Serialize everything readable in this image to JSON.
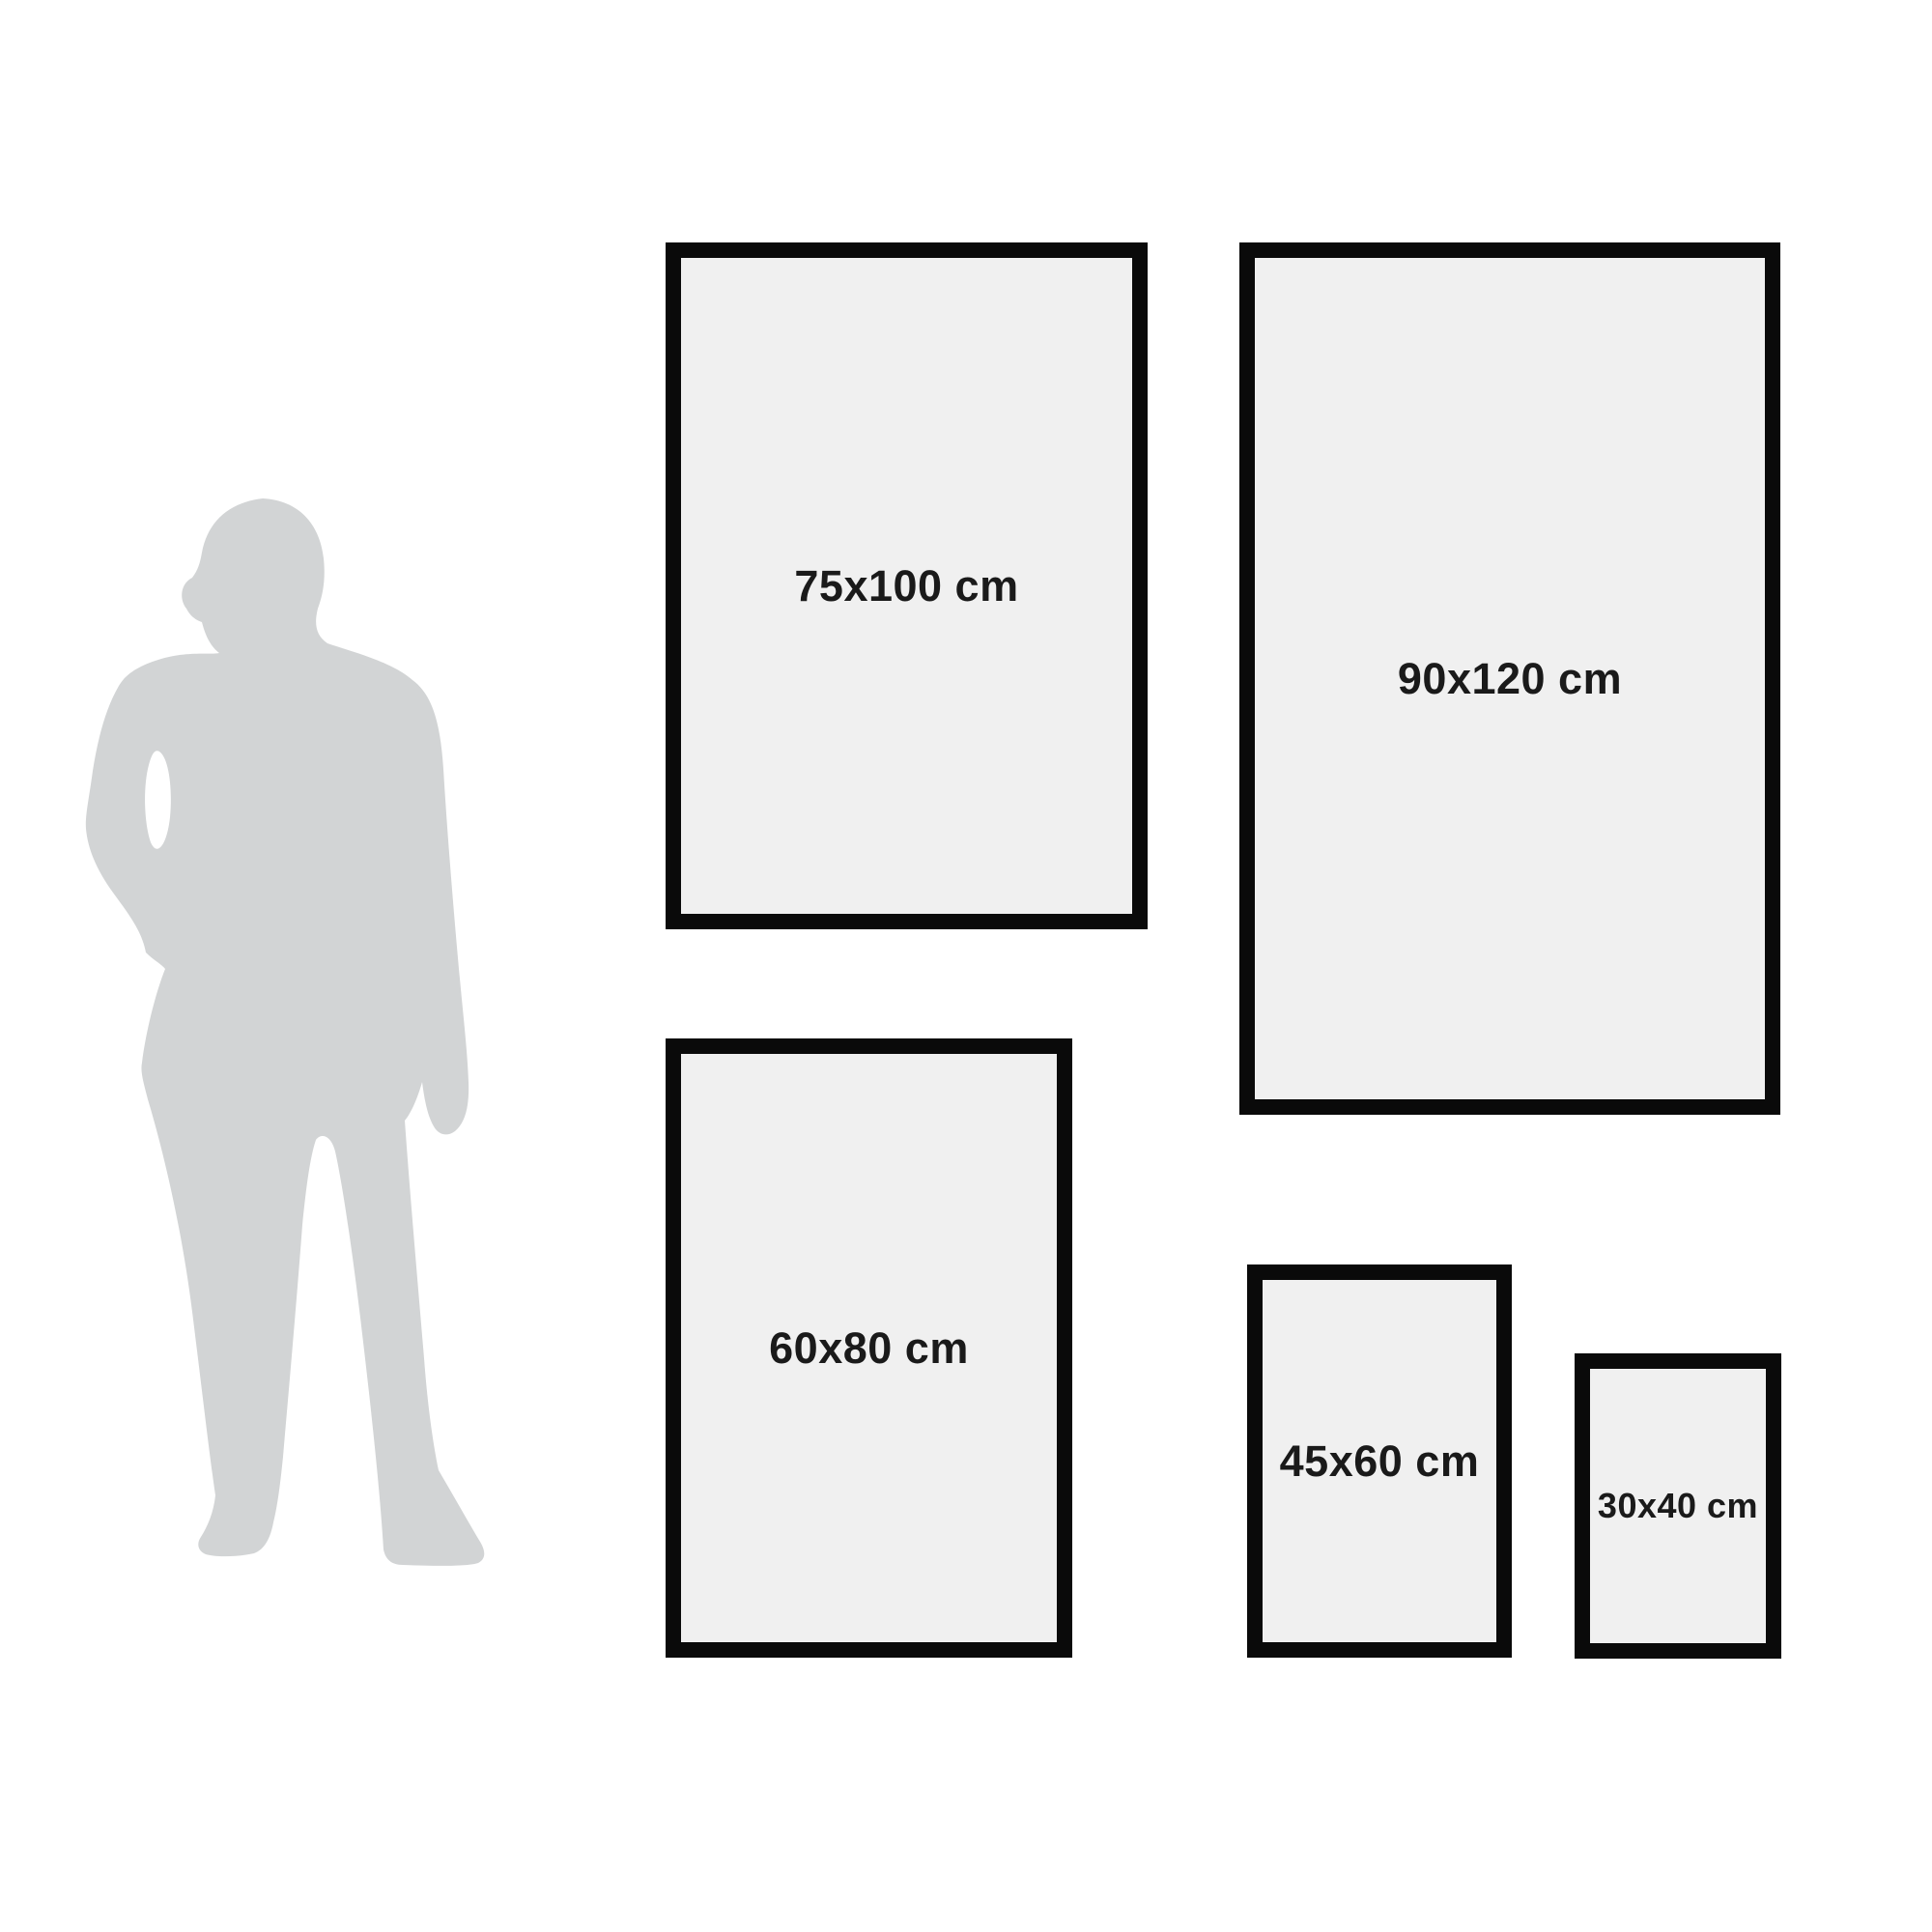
{
  "diagram": {
    "description": "poster-frame-size-comparison-with-human-silhouette",
    "silhouette": {
      "name": "standing-man-in-suit"
    },
    "frames": [
      {
        "label": "75x100 cm"
      },
      {
        "label": "90x120 cm"
      },
      {
        "label": "60x80 cm"
      },
      {
        "label": "45x60 cm"
      },
      {
        "label": "30x40 cm"
      }
    ],
    "colors": {
      "background": "#ffffff",
      "frame_border": "#0a0a0a",
      "frame_fill": "#f0f0f0",
      "label_text": "#1a1a1a",
      "silhouette": "#d2d4d5"
    }
  }
}
